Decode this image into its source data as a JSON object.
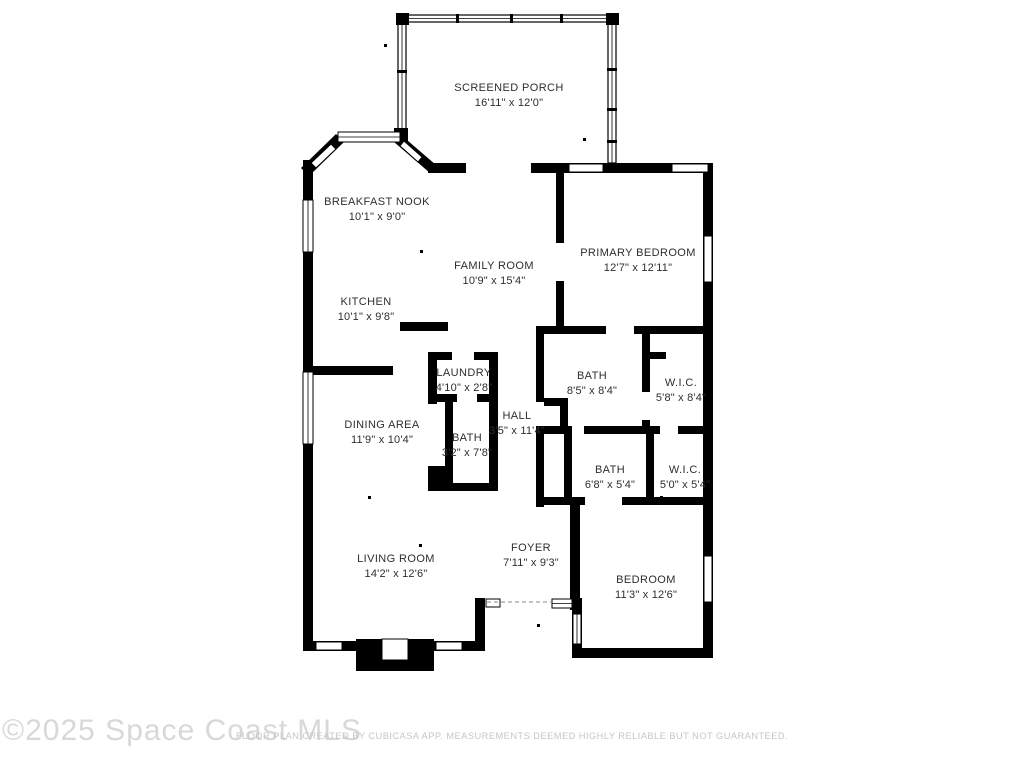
{
  "watermark": {
    "text": "©2025 Space Coast MLS",
    "color": "#d8d8d8"
  },
  "footer": {
    "text": "FLOOR PLAN CREATED BY CUBICASA APP. MEASUREMENTS DEEMED HIGHLY RELIABLE BUT NOT GUARANTEED.",
    "color": "#c2c6cb"
  },
  "floorplan": {
    "wall_color": "#000000",
    "background": "#ffffff",
    "rooms": [
      {
        "id": "screened-porch",
        "name": "SCREENED PORCH",
        "dims": "16'11\" x 12'0\"",
        "label_x": 509,
        "label_y": 91
      },
      {
        "id": "breakfast-nook",
        "name": "BREAKFAST NOOK",
        "dims": "10'1\" x 9'0\"",
        "label_x": 377,
        "label_y": 205
      },
      {
        "id": "family-room",
        "name": "FAMILY ROOM",
        "dims": "10'9\" x 15'4\"",
        "label_x": 494,
        "label_y": 269
      },
      {
        "id": "primary-bedroom",
        "name": "PRIMARY BEDROOM",
        "dims": "12'7\" x 12'11\"",
        "label_x": 638,
        "label_y": 256
      },
      {
        "id": "kitchen",
        "name": "KITCHEN",
        "dims": "10'1\" x 9'8\"",
        "label_x": 366,
        "label_y": 305
      },
      {
        "id": "laundry",
        "name": "LAUNDRY",
        "dims": "4'10\" x 2'8\"",
        "label_x": 464,
        "label_y": 376
      },
      {
        "id": "bath-main",
        "name": "BATH",
        "dims": "8'5\" x 8'4\"",
        "label_x": 592,
        "label_y": 379
      },
      {
        "id": "wic-primary",
        "name": "W.I.C.",
        "dims": "5'8\" x 8'4\"",
        "label_x": 681,
        "label_y": 386
      },
      {
        "id": "hall",
        "name": "HALL",
        "dims": "3'5\" x 11'4\"",
        "label_x": 517,
        "label_y": 419
      },
      {
        "id": "dining-area",
        "name": "DINING AREA",
        "dims": "11'9\" x 10'4\"",
        "label_x": 382,
        "label_y": 428
      },
      {
        "id": "bath-hall",
        "name": "BATH",
        "dims": "3'2\" x 7'8\"",
        "label_x": 467,
        "label_y": 441
      },
      {
        "id": "bath-second",
        "name": "BATH",
        "dims": "6'8\" x 5'4\"",
        "label_x": 610,
        "label_y": 473
      },
      {
        "id": "wic-second",
        "name": "W.I.C.",
        "dims": "5'0\" x 5'4\"",
        "label_x": 685,
        "label_y": 473
      },
      {
        "id": "living-room",
        "name": "LIVING ROOM",
        "dims": "14'2\" x 12'6\"",
        "label_x": 396,
        "label_y": 562
      },
      {
        "id": "foyer",
        "name": "FOYER",
        "dims": "7'11\" x 9'3\"",
        "label_x": 531,
        "label_y": 551
      },
      {
        "id": "bedroom",
        "name": "BEDROOM",
        "dims": "11'3\" x 12'6\"",
        "label_x": 646,
        "label_y": 583
      }
    ]
  }
}
